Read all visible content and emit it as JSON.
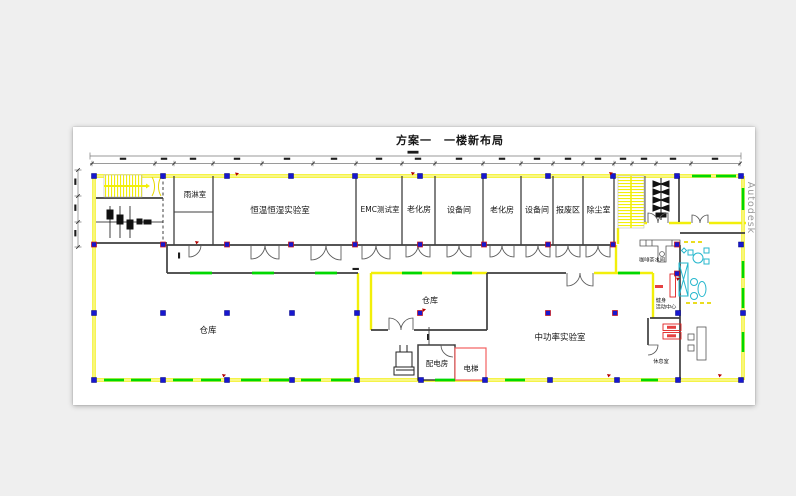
{
  "title": "方案一　一楼新布局",
  "watermark": "Autodesk",
  "rooms": {
    "rain": "雨淋室",
    "const_temp_humidity_lab": "恒温恒湿实验室",
    "emc_test": "EMC测试室",
    "aging_1": "老化房",
    "equipment_1": "设备间",
    "aging_2": "老化房",
    "equipment_2": "设备间",
    "scrap": "报废区",
    "dust": "除尘室",
    "warehouse_main": "仓库",
    "warehouse_small": "仓库",
    "mid_power_lab": "中功率实验室",
    "power_distribution": "配电房",
    "elevator": "电梯",
    "coffee_pantry": "咖啡茶水间",
    "fitness_line1": "健身",
    "fitness_line2": "活动中心",
    "lounge": "休息室"
  },
  "colors": {
    "canvas_gray": "#efefef",
    "sheet_white": "#ffffff",
    "wall_yellow": "#f2ef0a",
    "window_green": "#00d800",
    "column_blue": "#1717cf",
    "alert_red": "#e02020",
    "furniture_cyan": "#25b7cd",
    "wall_dark": "#3f3f3f",
    "watermark_gray": "#9a9a9a"
  }
}
